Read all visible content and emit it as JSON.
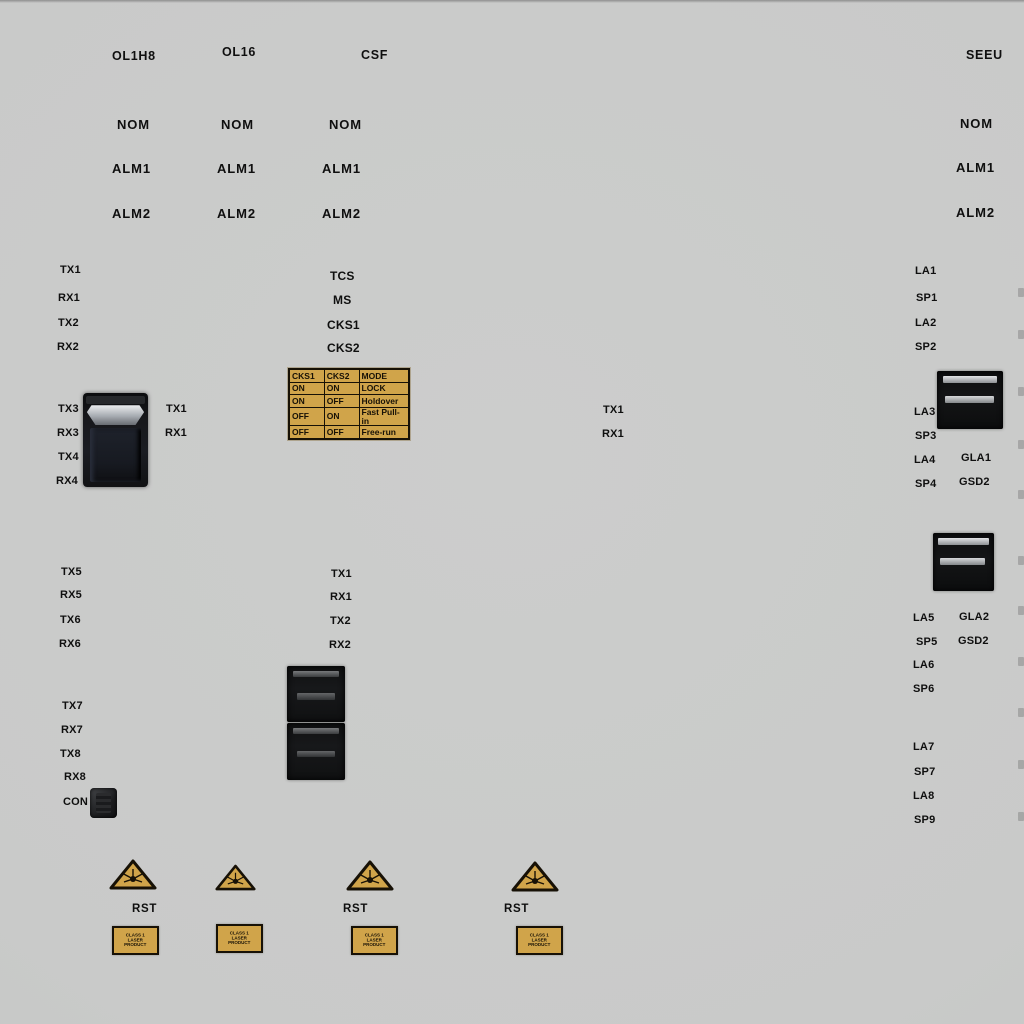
{
  "titles": {
    "card1": "OL1H8",
    "card2": "OL16",
    "card3": "CSF",
    "card4": "SEEU"
  },
  "leds": {
    "nom": "NOM",
    "alm1": "ALM1",
    "alm2": "ALM2"
  },
  "ol1h8_ports": {
    "g1": [
      "TX1",
      "RX1",
      "TX2",
      "RX2"
    ],
    "g2": [
      "TX3",
      "RX3",
      "TX4",
      "RX4"
    ],
    "g2_right": [
      "TX1",
      "RX1"
    ],
    "g3": [
      "TX5",
      "RX5",
      "TX6",
      "RX6"
    ],
    "g4": [
      "TX7",
      "RX7",
      "TX8",
      "RX8"
    ],
    "console": "CON"
  },
  "csf_panel": {
    "signals": [
      "TCS",
      "MS",
      "CKS1",
      "CKS2"
    ],
    "table": {
      "headers": [
        "CKS1",
        "CKS2",
        "MODE"
      ],
      "rows": [
        [
          "ON",
          "ON",
          "LOCK"
        ],
        [
          "ON",
          "OFF",
          "Holdover"
        ],
        [
          "OFF",
          "ON",
          "Fast Pull-in"
        ],
        [
          "OFF",
          "OFF",
          "Free-run"
        ]
      ]
    },
    "ports": [
      "TX1",
      "RX1",
      "TX2",
      "RX2"
    ]
  },
  "mid_ports": [
    "TX1",
    "RX1"
  ],
  "seeu_ports": {
    "g1": [
      "LA1",
      "SP1",
      "LA2",
      "SP2"
    ],
    "g2": [
      "LA3",
      "SP3",
      "LA4",
      "SP4"
    ],
    "g2_aux": [
      "GLA1",
      "GSD2"
    ],
    "g3": [
      "LA5",
      "SP5",
      "LA6",
      "SP6"
    ],
    "g3_aux": [
      "GLA2",
      "GSD2"
    ],
    "g4": [
      "LA7",
      "SP7",
      "LA8",
      "SP9"
    ]
  },
  "bottom": {
    "reset": "RST",
    "sticker": [
      "CLASS 1",
      "LASER",
      "PRODUCT"
    ]
  },
  "colors": {
    "panel_bg": "#c9cac9",
    "gold": "#d0a44a",
    "text": "#0f0f0f"
  }
}
